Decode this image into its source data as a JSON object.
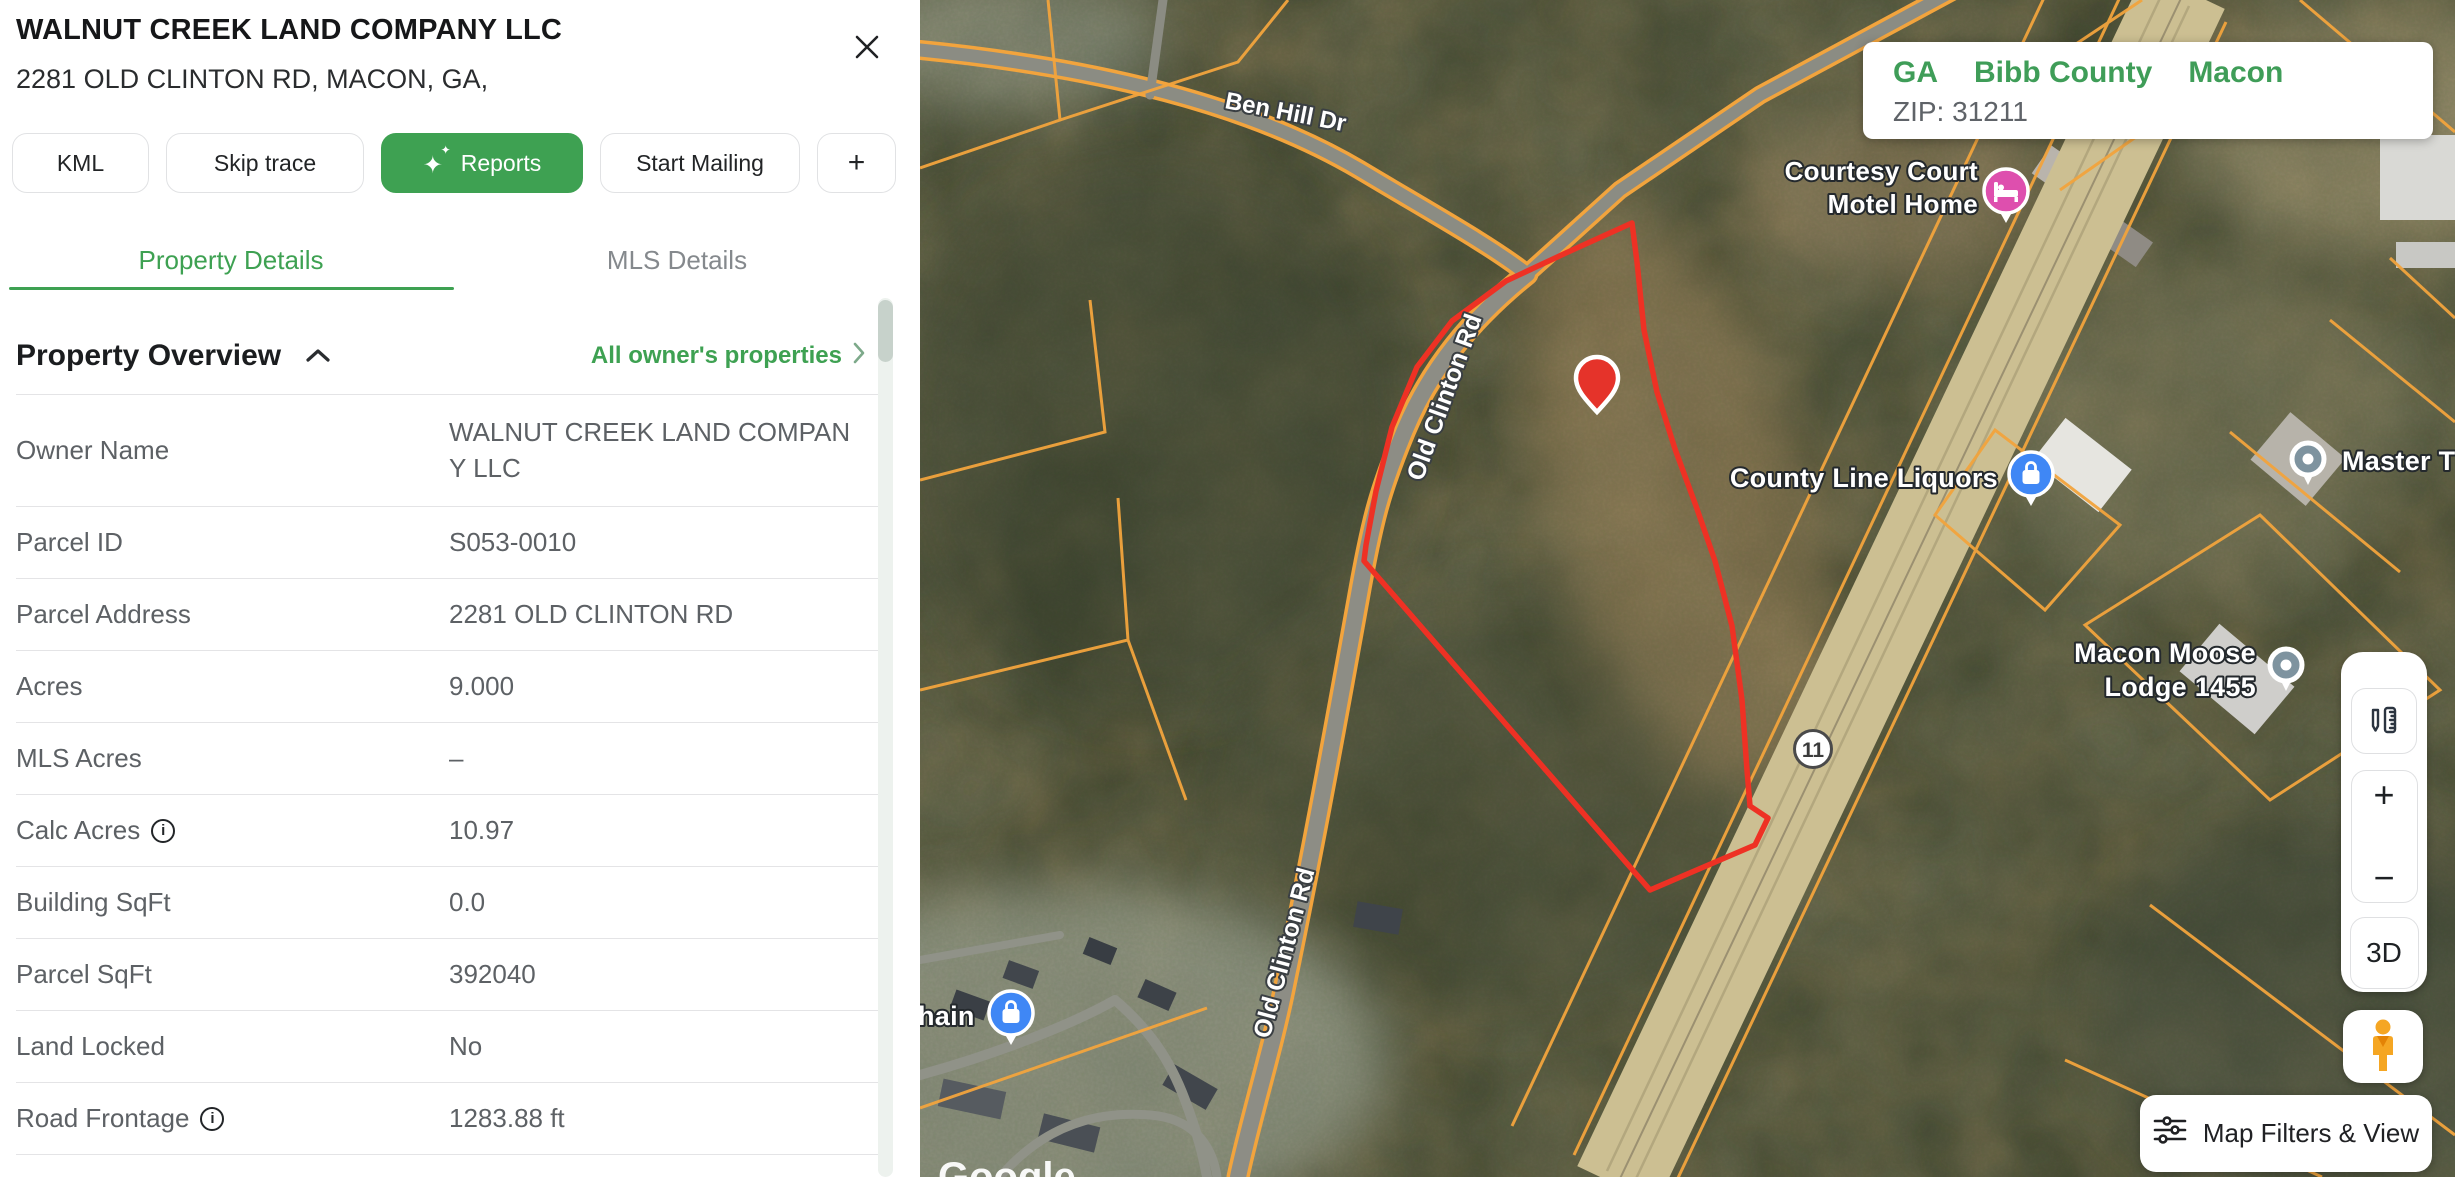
{
  "panel": {
    "title": "WALNUT CREEK LAND COMPANY LLC",
    "subtitle": "2281 OLD CLINTON RD, MACON, GA,",
    "buttons": {
      "kml": "KML",
      "skip_trace": "Skip trace",
      "reports": "Reports",
      "start_mailing": "Start Mailing",
      "add": "+"
    },
    "tabs": {
      "property_details": "Property Details",
      "mls_details": "MLS Details"
    },
    "overview": {
      "title": "Property Overview",
      "link": "All owner's properties"
    },
    "fields": [
      {
        "label": "Owner Name",
        "value": "WALNUT CREEK LAND COMPANY LLC"
      },
      {
        "label": "Parcel ID",
        "value": "S053-0010"
      },
      {
        "label": "Parcel Address",
        "value": "2281 OLD CLINTON RD"
      },
      {
        "label": "Acres",
        "value": "9.000"
      },
      {
        "label": "MLS Acres",
        "value": "–"
      },
      {
        "label": "Calc Acres",
        "value": "10.97",
        "info": true
      },
      {
        "label": "Building SqFt",
        "value": "0.0"
      },
      {
        "label": "Parcel SqFt",
        "value": "392040"
      },
      {
        "label": "Land Locked",
        "value": "No"
      },
      {
        "label": "Road Frontage",
        "value": "1283.88 ft",
        "info": true
      }
    ]
  },
  "map": {
    "location_card": {
      "state": "GA",
      "county": "Bibb County",
      "city": "Macon",
      "zip": "ZIP: 31211"
    },
    "pois": {
      "motel_line1": "Courtesy Court",
      "motel_line2": "Motel Home",
      "liquors": "County Line Liquors",
      "lodge_line1": "Macon Moose",
      "lodge_line2": "Lodge 1455",
      "master": "Master T",
      "chain": "hain"
    },
    "roads": {
      "ben_hill": "Ben Hill Dr",
      "old_clinton": "Old Clinton Rd",
      "route_11": "11"
    },
    "controls": {
      "zoom_in": "+",
      "zoom_out": "−",
      "three_d": "3D",
      "map_filters": "Map Filters & View"
    },
    "watermark": "Google"
  },
  "colors": {
    "accent_green": "#3EA152",
    "parcel_red": "#EE3124",
    "cadastral_orange": "#F2A43D",
    "poi_blue": "#3F87F5",
    "poi_pink": "#DE4FAE",
    "poi_gray": "#7E939F"
  }
}
